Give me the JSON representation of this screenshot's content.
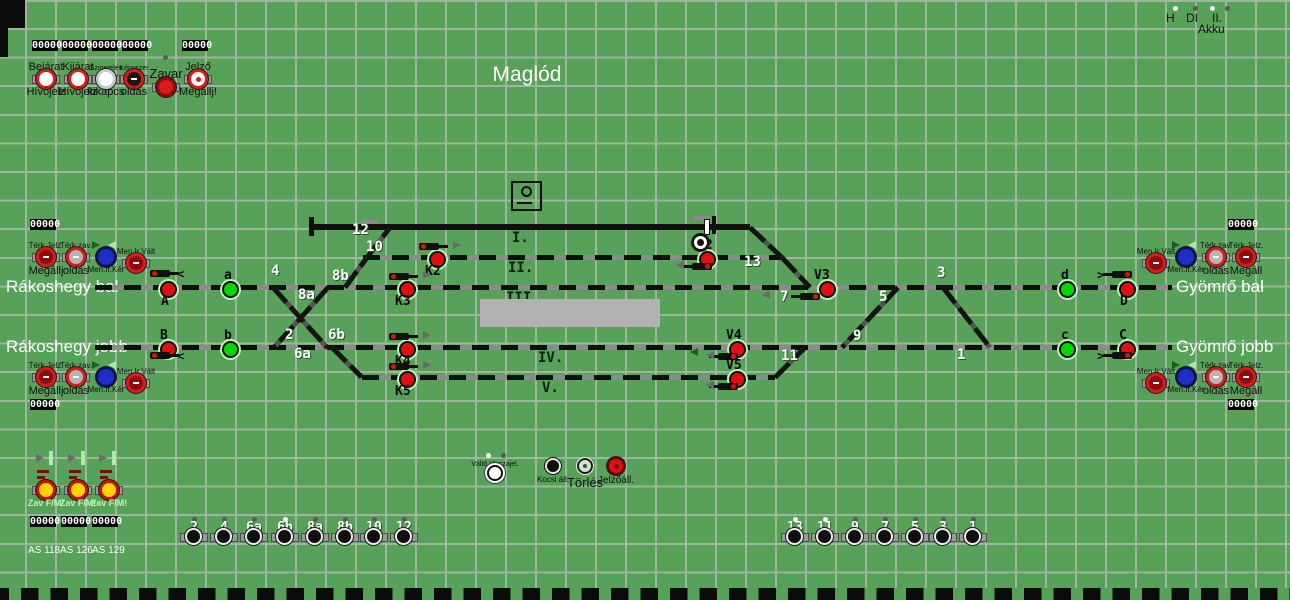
{
  "title": "Maglód",
  "stations": [
    {
      "text": "Rákoshegy bal",
      "x": 6,
      "y": 277
    },
    {
      "text": "Rákoshegy jobb",
      "x": 6,
      "y": 337
    },
    {
      "text": "Gyömrő bal",
      "x": 1176,
      "y": 277
    },
    {
      "text": "Gyömrő jobb",
      "x": 1176,
      "y": 337
    }
  ],
  "top_right": {
    "labels": [
      {
        "text": "H",
        "x": 1166
      },
      {
        "text": "DI",
        "x": 1186
      },
      {
        "text": "II.",
        "x": 1212
      }
    ],
    "dots": [
      {
        "x": 1173,
        "lit": true
      },
      {
        "x": 1193,
        "lit": false
      },
      {
        "x": 1210,
        "lit": true
      },
      {
        "x": 1225,
        "lit": false
      }
    ],
    "akku": {
      "text": "Akku",
      "x": 1198,
      "y": 22
    }
  },
  "counters": [
    {
      "value": "00000",
      "x": 32,
      "y": 40
    },
    {
      "value": "00000",
      "x": 62,
      "y": 40
    },
    {
      "value": "00000",
      "x": 92,
      "y": 40
    },
    {
      "value": "00000",
      "x": 122,
      "y": 40
    },
    {
      "value": "00000",
      "x": 182,
      "y": 40
    },
    {
      "value": "00000",
      "x": 30,
      "y": 219
    },
    {
      "value": "00000",
      "x": 1228,
      "y": 219
    },
    {
      "value": "00000",
      "x": 30,
      "y": 399
    },
    {
      "value": "00000",
      "x": 1228,
      "y": 399
    },
    {
      "value": "00000",
      "x": 30,
      "y": 516
    },
    {
      "value": "00000",
      "x": 61,
      "y": 516
    },
    {
      "value": "00000",
      "x": 92,
      "y": 516
    }
  ],
  "header_buttons": [
    {
      "x": 46,
      "top": "Bejárat",
      "bottom": "Hívójelz",
      "type": "redwhite",
      "smallTop": false
    },
    {
      "x": 78,
      "top": "Kijárat",
      "bottom": "Hívójelz",
      "type": "redwhite",
      "smallTop": false
    },
    {
      "x": 106,
      "top": "Szigetelés",
      "bottom": "kikapcs",
      "type": "whitebtn",
      "smallTop": true
    },
    {
      "x": 134,
      "top": "Kényszer",
      "bottom": "oldás",
      "type": "reddark",
      "smallTop": true
    },
    {
      "x": 166,
      "label": "Zavar",
      "type": "redsolid",
      "dot": true
    },
    {
      "x": 198,
      "top": "Jelző",
      "bottom": "Megállj!",
      "type": "jelzo",
      "smallTop": false
    }
  ],
  "side_buttons": [
    {
      "x": 46,
      "btnY": 257,
      "top": "Térk.Jelz.",
      "bottom": "Megállj",
      "type": "red"
    },
    {
      "x": 76,
      "btnY": 257,
      "top": "Térk.zav.",
      "bottom": "oldás",
      "type": "redgray"
    },
    {
      "x": 106,
      "btnY": 257,
      "bottom": "Men.Ir.Kér",
      "type": "blue",
      "arrows": true
    },
    {
      "x": 136,
      "btnY": 263,
      "top": "Men.Ir.Vált",
      "type": "red"
    },
    {
      "x": 46,
      "btnY": 377,
      "top": "Térk.Jelz.",
      "bottom": "Megállj",
      "type": "red"
    },
    {
      "x": 76,
      "btnY": 377,
      "top": "Térk.zav.",
      "bottom": "oldás",
      "type": "redgray"
    },
    {
      "x": 106,
      "btnY": 377,
      "bottom": "Men.Ir.Kér",
      "type": "blue",
      "arrows": true
    },
    {
      "x": 136,
      "btnY": 383,
      "top": "Men.Ir.Vált",
      "type": "red"
    },
    {
      "x": 1156,
      "btnY": 263,
      "top": "Men.Ir.Vált",
      "type": "red"
    },
    {
      "x": 1186,
      "btnY": 257,
      "bottom": "Men.Ir.Kér",
      "type": "blue",
      "arrows": true
    },
    {
      "x": 1216,
      "btnY": 257,
      "top": "Térk.zav.",
      "bottom": "oldás",
      "type": "redgray"
    },
    {
      "x": 1246,
      "btnY": 257,
      "top": "Térk.Jelz.",
      "bottom": "Megáll",
      "type": "red"
    },
    {
      "x": 1156,
      "btnY": 383,
      "top": "Men.Ir.Vált",
      "type": "red"
    },
    {
      "x": 1186,
      "btnY": 377,
      "bottom": "Men.Ir.Kér",
      "type": "blue",
      "arrows": true
    },
    {
      "x": 1216,
      "btnY": 377,
      "top": "Térk.zav.",
      "bottom": "oldás",
      "type": "redgray"
    },
    {
      "x": 1246,
      "btnY": 377,
      "top": "Térk.Jelz.",
      "bottom": "Megáll",
      "type": "red"
    }
  ],
  "route_buttons": [
    {
      "x": 495,
      "y": 473,
      "type": "rwhite",
      "label": "Váltó Visszajel.",
      "labelPos": "above",
      "labelSize": 7,
      "dots": true
    },
    {
      "x": 553,
      "y": 466,
      "type": "rdark",
      "label": "Kocsi áll.",
      "labelPos": "below",
      "labelSize": 8
    },
    {
      "x": 585,
      "y": 466,
      "type": "rpale",
      "label": "Törlés",
      "labelPos": "below",
      "labelSize": 13
    },
    {
      "x": 616,
      "y": 466,
      "type": "rred",
      "label": "Jelzőáll.",
      "labelPos": "below",
      "labelSize": 10
    }
  ],
  "zav_block": {
    "columns": [
      {
        "x": 46
      },
      {
        "x": 78
      },
      {
        "x": 109
      }
    ],
    "button_label": "Zav F/M!",
    "as_labels": [
      {
        "text": "AS 118",
        "x": 28,
        "y": 545
      },
      {
        "text": "AS 126",
        "x": 60,
        "y": 545
      },
      {
        "text": "AS 129",
        "x": 92,
        "y": 545
      }
    ]
  },
  "switch_buttons": [
    {
      "label": "2",
      "x": 194,
      "lit": false
    },
    {
      "label": "4",
      "x": 224,
      "lit": false
    },
    {
      "label": "6a",
      "x": 254,
      "lit": false
    },
    {
      "label": "6b",
      "x": 285,
      "lit": true
    },
    {
      "label": "8a",
      "x": 315,
      "lit": false
    },
    {
      "label": "8b",
      "x": 345,
      "lit": false
    },
    {
      "label": "10",
      "x": 374,
      "lit": false
    },
    {
      "label": "12",
      "x": 404,
      "lit": false
    },
    {
      "label": "13",
      "x": 795,
      "lit": true
    },
    {
      "label": "11",
      "x": 825,
      "lit": true
    },
    {
      "label": "9",
      "x": 855,
      "lit": false
    },
    {
      "label": "7",
      "x": 885,
      "lit": false
    },
    {
      "label": "5",
      "x": 915,
      "lit": false
    },
    {
      "label": "3",
      "x": 943,
      "lit": false
    },
    {
      "label": "1",
      "x": 973,
      "lit": false
    }
  ],
  "diagram": {
    "tracks": [
      {
        "name": "I.",
        "x1": 312,
        "x2": 750,
        "y": 227,
        "solid": true
      },
      {
        "name": "II.",
        "x1": 363,
        "x2": 782,
        "y": 257,
        "solid": false
      },
      {
        "name": "III.",
        "x1": 95,
        "x2": 1172,
        "y": 287,
        "solid": false
      },
      {
        "name": "IV.",
        "x1": 95,
        "x2": 1172,
        "y": 347,
        "solid": false
      },
      {
        "name": "V.",
        "x1": 362,
        "x2": 775,
        "y": 377,
        "solid": false
      }
    ],
    "diagonals": [
      [
        345,
        287,
        367,
        257
      ],
      [
        367,
        257,
        390,
        227
      ],
      [
        273,
        287,
        327,
        347
      ],
      [
        328,
        287,
        274,
        347
      ],
      [
        332,
        347,
        362,
        377
      ],
      [
        750,
        227,
        782,
        257
      ],
      [
        782,
        257,
        810,
        287
      ],
      [
        898,
        287,
        842,
        347
      ],
      [
        943,
        287,
        990,
        347
      ],
      [
        775,
        377,
        805,
        347
      ]
    ],
    "track_labels": [
      {
        "t": "I.",
        "x": 512,
        "y": 230
      },
      {
        "t": "II.",
        "x": 508,
        "y": 260
      },
      {
        "t": "III.",
        "x": 506,
        "y": 290
      },
      {
        "t": "IV.",
        "x": 538,
        "y": 350
      },
      {
        "t": "V.",
        "x": 542,
        "y": 380
      }
    ],
    "switch_labels": [
      {
        "t": "12",
        "x": 352,
        "y": 222
      },
      {
        "t": "10",
        "x": 366,
        "y": 239
      },
      {
        "t": "8b",
        "x": 332,
        "y": 268
      },
      {
        "t": "4",
        "x": 271,
        "y": 263
      },
      {
        "t": "8a",
        "x": 298,
        "y": 287
      },
      {
        "t": "2",
        "x": 285,
        "y": 327
      },
      {
        "t": "6b",
        "x": 328,
        "y": 327
      },
      {
        "t": "6a",
        "x": 294,
        "y": 346
      },
      {
        "t": "13",
        "x": 744,
        "y": 254
      },
      {
        "t": "7",
        "x": 780,
        "y": 289
      },
      {
        "t": "5",
        "x": 879,
        "y": 289
      },
      {
        "t": "9",
        "x": 853,
        "y": 328
      },
      {
        "t": "3",
        "x": 937,
        "y": 265
      },
      {
        "t": "1",
        "x": 957,
        "y": 347
      },
      {
        "t": "11",
        "x": 781,
        "y": 348
      }
    ],
    "signals": [
      {
        "id": "A",
        "x": 166,
        "y": 287,
        "state": "red",
        "label": {
          "x": 161,
          "y": 294
        },
        "mast": {
          "x": 150,
          "y": 270,
          "dir": "right"
        },
        "glyph": {
          "t": "<",
          "x": 177,
          "y": 267
        }
      },
      {
        "id": "a",
        "x": 228,
        "y": 287,
        "state": "green",
        "label": {
          "x": 224,
          "y": 268
        }
      },
      {
        "id": "B",
        "x": 166,
        "y": 347,
        "state": "red",
        "label": {
          "x": 160,
          "y": 328
        },
        "mast": {
          "x": 150,
          "y": 352,
          "dir": "right"
        },
        "glyph": {
          "t": "<",
          "x": 177,
          "y": 349
        }
      },
      {
        "id": "b",
        "x": 228,
        "y": 347,
        "state": "green",
        "label": {
          "x": 224,
          "y": 328
        }
      },
      {
        "id": "K2",
        "x": 435,
        "y": 257,
        "state": "red",
        "label": {
          "x": 425,
          "y": 264
        },
        "mast": {
          "x": 419,
          "y": 243,
          "dir": "right"
        },
        "tri": [
          {
            "x": 453,
            "y": 241,
            "dir": "r",
            "c": "gray"
          }
        ]
      },
      {
        "id": "K3",
        "x": 405,
        "y": 287,
        "state": "red",
        "label": {
          "x": 395,
          "y": 294
        },
        "mast": {
          "x": 389,
          "y": 273,
          "dir": "right"
        },
        "tri": [
          {
            "x": 423,
            "y": 271,
            "dir": "r",
            "c": "gray"
          }
        ]
      },
      {
        "id": "K4",
        "x": 405,
        "y": 347,
        "state": "red",
        "label": {
          "x": 395,
          "y": 354
        },
        "mast": {
          "x": 389,
          "y": 333,
          "dir": "right"
        },
        "tri": [
          {
            "x": 423,
            "y": 331,
            "dir": "r",
            "c": "gray"
          }
        ]
      },
      {
        "id": "K5",
        "x": 405,
        "y": 377,
        "state": "red",
        "label": {
          "x": 395,
          "y": 384
        },
        "mast": {
          "x": 389,
          "y": 363,
          "dir": "right"
        },
        "tri": [
          {
            "x": 423,
            "y": 361,
            "dir": "r",
            "c": "gray"
          }
        ]
      },
      {
        "id": "V2",
        "x": 705,
        "y": 257,
        "state": "red",
        "label": {
          "x": 697,
          "y": 238
        },
        "mast": {
          "x": 692,
          "y": 263,
          "dir": "left"
        },
        "tri": [
          {
            "x": 676,
            "y": 261,
            "dir": "l",
            "c": "gray"
          }
        ]
      },
      {
        "id": "V3",
        "x": 825,
        "y": 287,
        "state": "red",
        "label": {
          "x": 814,
          "y": 268
        },
        "mast": {
          "x": 800,
          "y": 293,
          "dir": "left"
        },
        "tri": [
          {
            "x": 762,
            "y": 291,
            "dir": "l",
            "c": "gray"
          }
        ]
      },
      {
        "id": "V4",
        "x": 735,
        "y": 347,
        "state": "red",
        "label": {
          "x": 726,
          "y": 328
        },
        "mast": {
          "x": 718,
          "y": 353,
          "dir": "left"
        },
        "tri": [
          {
            "x": 690,
            "y": 348,
            "dir": "l",
            "c": "green"
          },
          {
            "x": 706,
            "y": 351,
            "dir": "l",
            "c": "gray"
          }
        ]
      },
      {
        "id": "V5",
        "x": 735,
        "y": 377,
        "state": "red",
        "label": {
          "x": 726,
          "y": 358
        },
        "mast": {
          "x": 718,
          "y": 383,
          "dir": "left"
        },
        "tri": [
          {
            "x": 706,
            "y": 381,
            "dir": "l",
            "c": "gray"
          }
        ]
      },
      {
        "id": "d",
        "x": 1065,
        "y": 287,
        "state": "green",
        "label": {
          "x": 1061,
          "y": 268
        }
      },
      {
        "id": "D",
        "x": 1125,
        "y": 287,
        "state": "red",
        "label": {
          "x": 1120,
          "y": 294
        },
        "mast": {
          "x": 1112,
          "y": 271,
          "dir": "left"
        },
        "glyph": {
          "t": ">",
          "x": 1097,
          "y": 268
        }
      },
      {
        "id": "c",
        "x": 1065,
        "y": 347,
        "state": "green",
        "label": {
          "x": 1061,
          "y": 328
        }
      },
      {
        "id": "C",
        "x": 1125,
        "y": 347,
        "state": "red",
        "label": {
          "x": 1119,
          "y": 328
        },
        "mast": {
          "x": 1112,
          "y": 352,
          "dir": "left"
        },
        "glyph": {
          "t": ">",
          "x": 1097,
          "y": 349
        }
      },
      {
        "id": "tolatasjelzo",
        "x": 698,
        "y": 240,
        "state": "white"
      }
    ],
    "extras": [
      {
        "type": "platform",
        "x": 480,
        "y": 299,
        "w": 180,
        "h": 28
      },
      {
        "type": "building",
        "x": 511,
        "y": 181
      },
      {
        "type": "gdash",
        "x": 362,
        "y": 220,
        "w": 16,
        "h": 4
      },
      {
        "type": "gdash",
        "x": 694,
        "y": 216,
        "w": 16,
        "h": 4
      },
      {
        "type": "vbarb",
        "x": 309,
        "y": 217,
        "w": 5,
        "h": 19
      },
      {
        "type": "vbarw",
        "x": 704,
        "y": 219,
        "w": 4,
        "h": 14
      },
      {
        "type": "vbarb",
        "x": 712,
        "y": 216,
        "w": 4,
        "h": 18
      }
    ]
  },
  "colors": {
    "background": "#58a158",
    "grid": "#9cb79c",
    "track": "#0f0f0f",
    "signal_red": "#e01010",
    "signal_green": "#00d800",
    "signal_halo": "#bdf0bd",
    "button_blue": "#1f2ec4",
    "button_yellow": "#ffd400",
    "platform_gray": "#b2b2b2"
  }
}
